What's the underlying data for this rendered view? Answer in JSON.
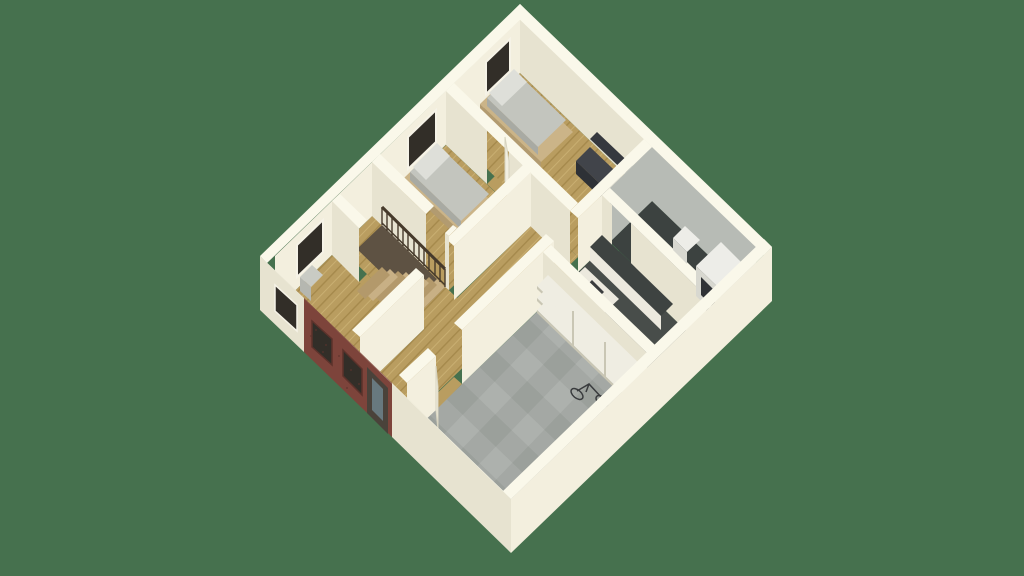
{
  "scene": {
    "type": "isometric-floorplan-render",
    "background": "#46714E"
  },
  "colors": {
    "bg": "#46714E",
    "wallTop": "#FAF8EA",
    "wallLit": "#F3EFDE",
    "wallFace": "#E7E3D0",
    "wallDim": "#D7D3BF",
    "woodBase": "#B99D60",
    "woodDark": "#A5894C",
    "woodLight": "#C9AF72",
    "concrete": "#A4A8A4",
    "concreteDark": "#9BA09B",
    "concreteLight": "#ADB1AD",
    "darkFloor": "#3C4240",
    "kitchenFloor": "#484D4A",
    "bathWall": "#B7BBB5",
    "brick": "#7D443B",
    "brickDark": "#5C322B",
    "windowDark": "#322E28",
    "frameWhite": "#F6F3E7",
    "doorWhite": "#F2EFE1",
    "doorDark": "#4A423A",
    "glass": "#68797F",
    "bedFrame": "#CBB488",
    "bedFrameShade": "#B29B70",
    "mattress": "#C3C5BE",
    "mattressShade": "#A8AAA3",
    "pillow": "#DEDFD9",
    "sofa": "#41444A",
    "sofaBack": "#35383E",
    "sofaShade": "#2E3136",
    "treadA": "#C8B085",
    "treadB": "#B3996B",
    "stairPit": "#5E5243",
    "railDark": "#463A2B",
    "shelf": "#EFEDE2",
    "shelfShadow": "#C9C6B4",
    "cabinet": "#ECE9DE",
    "cabinetShade": "#DCD8C7",
    "counterTop": "#3E4341",
    "fixtureWhite": "#EDEDE8",
    "fixtureShade": "#D8D8D0",
    "applianceSide": "#C7C7BE",
    "applianceDoor": "#2F3235",
    "radiator": "#C9CBC4",
    "radiatorShade": "#B5B7B0",
    "metalDark": "#3A3C3E"
  }
}
